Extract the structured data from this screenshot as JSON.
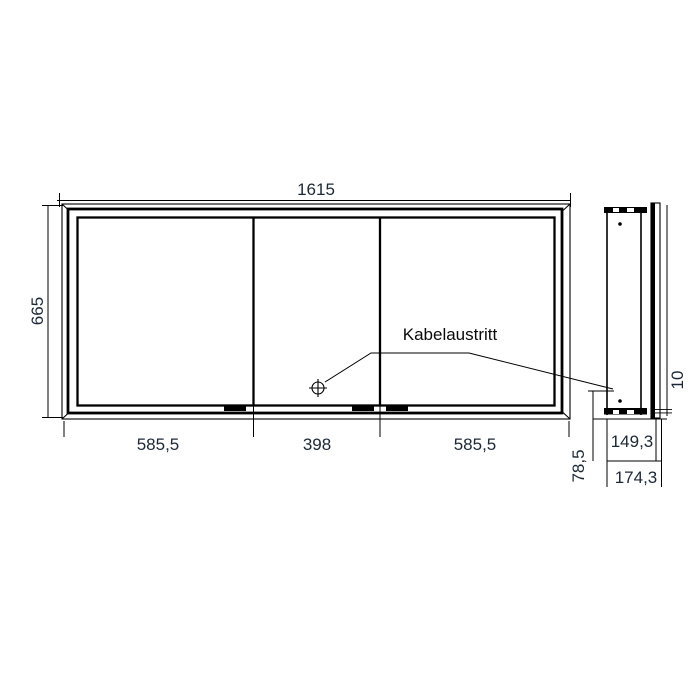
{
  "diagram": {
    "type": "technical-dimension-drawing",
    "views": {
      "front": "mirror cabinet front view with three sliding doors",
      "side": "mirror cabinet side profile view"
    },
    "label": {
      "kabelaustritt": "Kabelaustritt"
    },
    "dimensions": {
      "overall_width": "1615",
      "overall_height": "665",
      "left_door_width": "585,5",
      "middle_door_width": "398",
      "right_door_width": "585,5",
      "body_depth": "149,3",
      "overall_depth": "174,3",
      "cable_outlet_offset": "78,5",
      "door_overhang": "10"
    },
    "colors": {
      "line": "#000000",
      "dimension_text": "#1c2836",
      "background": "#ffffff"
    }
  }
}
